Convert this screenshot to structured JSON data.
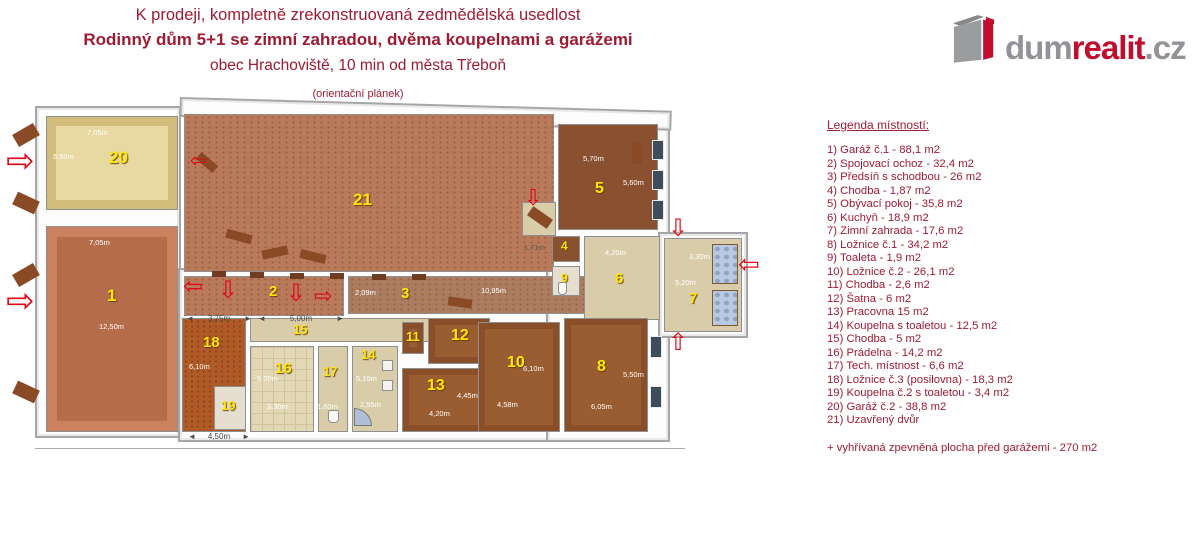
{
  "header": {
    "title_line1": "K prodeji, kompletně zrekonstruovaná zedmědělská usedlost",
    "title_line2": "Rodinný dům 5+1 se zimní zahradou, dvěma koupelnami a garážemi",
    "title_line3": "obec Hrachoviště, 10 min od města Třeboň",
    "title_line4": "(orientační plánek)"
  },
  "logo": {
    "text_gray1": "dum",
    "text_red": "realit",
    "text_gray2": ".cz"
  },
  "watermark_text": "dumrealit.cz",
  "legend": {
    "heading": "Legenda místností:",
    "items": [
      "1) Garáž č.1 - 88,1 m2",
      "2) Spojovací ochoz - 32,4 m2",
      "3) Předsíň s schodbou - 26 m2",
      "4) Chodba - 1,87 m2",
      "5) Obývací pokoj - 35,8 m2",
      "6) Kuchyň - 18,9 m2",
      "7) Zimní zahrada - 17,6 m2",
      "8) Ložnice č.1 - 34,2 m2",
      "9) Toaleta - 1,9 m2",
      "10) Ložnice č.2 - 26,1 m2",
      "11) Chodba - 2,6 m2",
      "12) Šatna - 6 m2",
      "13) Pracovna 15 m2",
      "14) Koupelna s toaletou - 12,5 m2",
      "15) Chodba - 5 m2",
      "16) Prádelna - 14,2 m2",
      "17) Tech. místnost - 6,6 m2",
      "18) Ložnice č.3 (posilovna) - 18,3 m2",
      "19) Koupelna č.2 s toaletou - 3,4 m2",
      "20) Garáž č.2 - 38,8 m2",
      "21) Uzavřený dvůr"
    ],
    "footnote": "+ vyhřívaná zpevněná plocha před garážemi - 270 m2"
  },
  "plan": {
    "rooms": {
      "1": {
        "number": "1",
        "dims": [
          "7,05m",
          "12,50m"
        ]
      },
      "2": {
        "number": "2",
        "dims": []
      },
      "3": {
        "number": "3",
        "dims": [
          "10,95m",
          "2,09m"
        ]
      },
      "4": {
        "number": "4",
        "dims": [
          "1,71m"
        ]
      },
      "5": {
        "number": "5",
        "dims": [
          "5,70m",
          "5,60m"
        ]
      },
      "6": {
        "number": "6",
        "dims": [
          "4,20m"
        ]
      },
      "7": {
        "number": "7",
        "dims": [
          "3,30m",
          "5,20m"
        ]
      },
      "8": {
        "number": "8",
        "dims": [
          "6,05m",
          "5,50m"
        ]
      },
      "9": {
        "number": "9",
        "dims": []
      },
      "10": {
        "number": "10",
        "dims": [
          "4,58m",
          "6,10m"
        ]
      },
      "11": {
        "number": "11",
        "dims": []
      },
      "12": {
        "number": "12",
        "dims": []
      },
      "13": {
        "number": "13",
        "dims": [
          "4,20m",
          "4,45m"
        ]
      },
      "14": {
        "number": "14",
        "dims": [
          "2,55m",
          "5,10m"
        ]
      },
      "15": {
        "number": "15",
        "dims": []
      },
      "16": {
        "number": "16",
        "dims": [
          "3,30m",
          "5,00m"
        ]
      },
      "17": {
        "number": "17",
        "dims": [
          "1,60m"
        ]
      },
      "18": {
        "number": "18",
        "dims": [
          "6,10m"
        ]
      },
      "19": {
        "number": "19",
        "dims": []
      },
      "20": {
        "number": "20",
        "dims": [
          "7,05m",
          "5,50m"
        ]
      },
      "21": {
        "number": "21",
        "dims": []
      }
    },
    "exterior_dims": [
      "3,75m",
      "5,00m",
      "4,50m"
    ]
  },
  "colors": {
    "title_red": "#9e1b33",
    "arrow_red": "#e30613",
    "logo_red": "#c20e2e",
    "logo_gray": "#919396"
  }
}
